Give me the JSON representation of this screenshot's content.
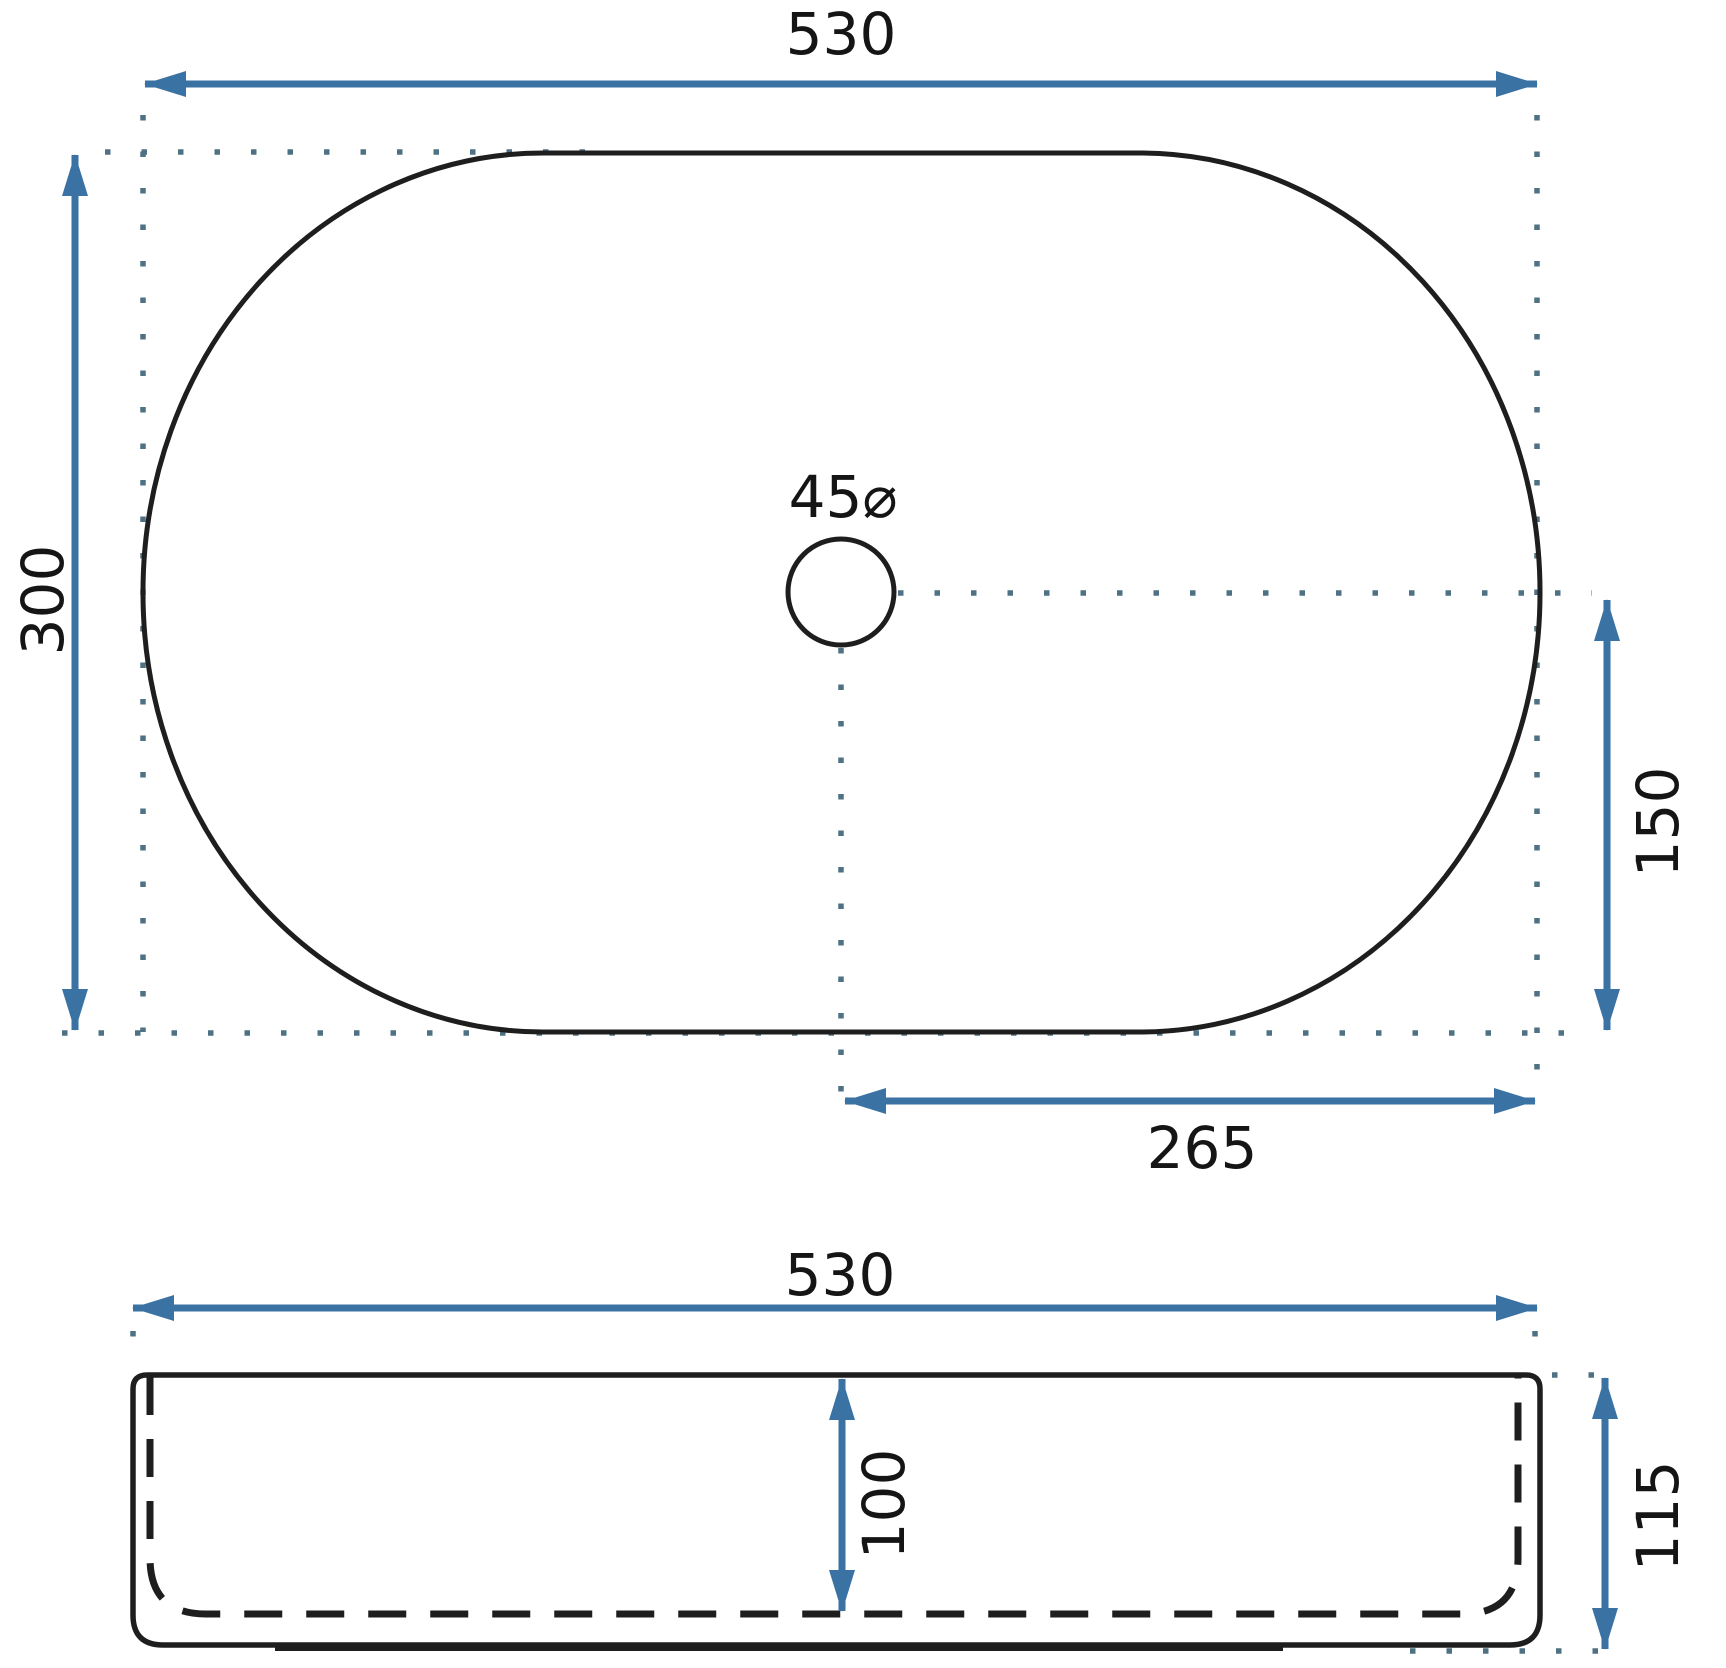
{
  "drawing": {
    "title": "washbasin-dimension-drawing",
    "colors": {
      "dimension_blue": "#3a72a3",
      "guide_dot_color": "#4e7184",
      "outline_black": "#1e1e1e",
      "label_black": "#151515",
      "background": "#ffffff"
    },
    "top_view": {
      "width_label": "530",
      "height_label": "300",
      "drain_diameter_label": "45⌀",
      "center_to_right_label": "265",
      "center_to_bottom_label": "150"
    },
    "side_view": {
      "width_label": "530",
      "basin_depth_label": "100",
      "total_height_label": "115"
    }
  }
}
